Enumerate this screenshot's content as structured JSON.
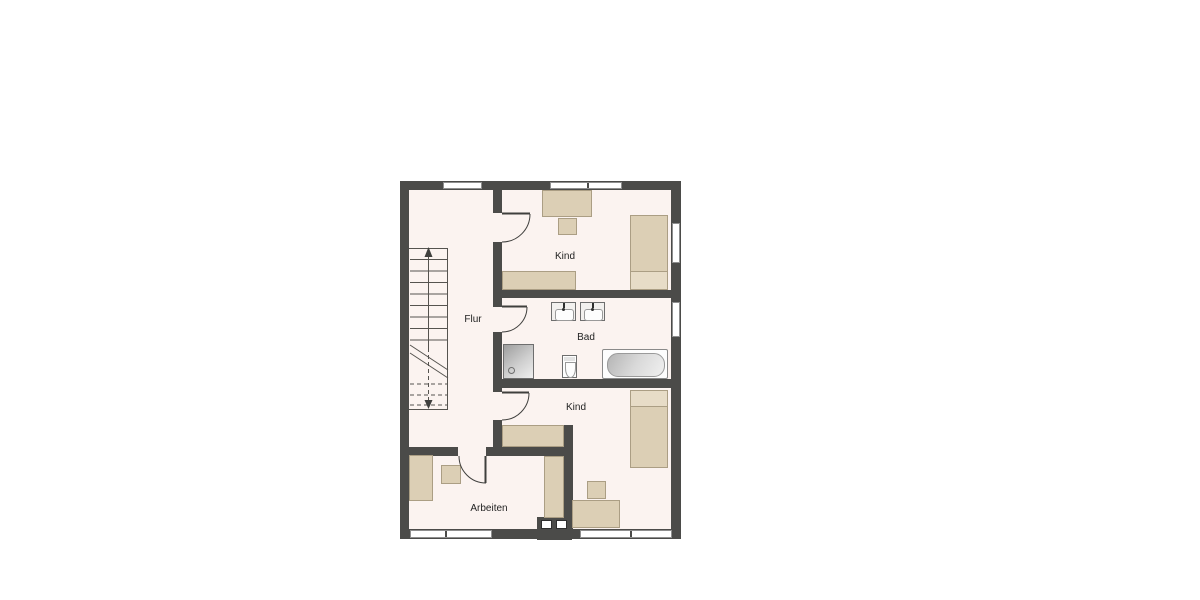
{
  "plan": {
    "type": "floor-plan",
    "floor_label_language": "de",
    "rooms": {
      "flur": {
        "label": "Flur",
        "furniture": [
          "staircase"
        ]
      },
      "kind_top": {
        "label": "Kind",
        "furniture": [
          "desk",
          "chair",
          "bed",
          "sideboard"
        ]
      },
      "bad": {
        "label": "Bad",
        "furniture": [
          "washbasin",
          "washbasin",
          "shower",
          "toilet",
          "bathtub"
        ]
      },
      "kind_bottom": {
        "label": "Kind",
        "furniture": [
          "bed",
          "sideboard",
          "desk",
          "chair"
        ]
      },
      "arbeiten": {
        "label": "Arbeiten",
        "furniture": [
          "desk",
          "chair",
          "wardrobe"
        ]
      }
    },
    "stairs": {
      "direction": "up",
      "lower_run_style": "dashed-below-cut-line"
    },
    "openings": {
      "doors": 4,
      "windows": 6,
      "chimney_flues": 2
    }
  },
  "colors": {
    "wall": "#4b4b49",
    "floor": "#fbf3f0",
    "furniture": "#dccfb5",
    "furniture_light": "#e7dcc7",
    "furniture_border": "#ab9e84",
    "text": "#222222"
  }
}
